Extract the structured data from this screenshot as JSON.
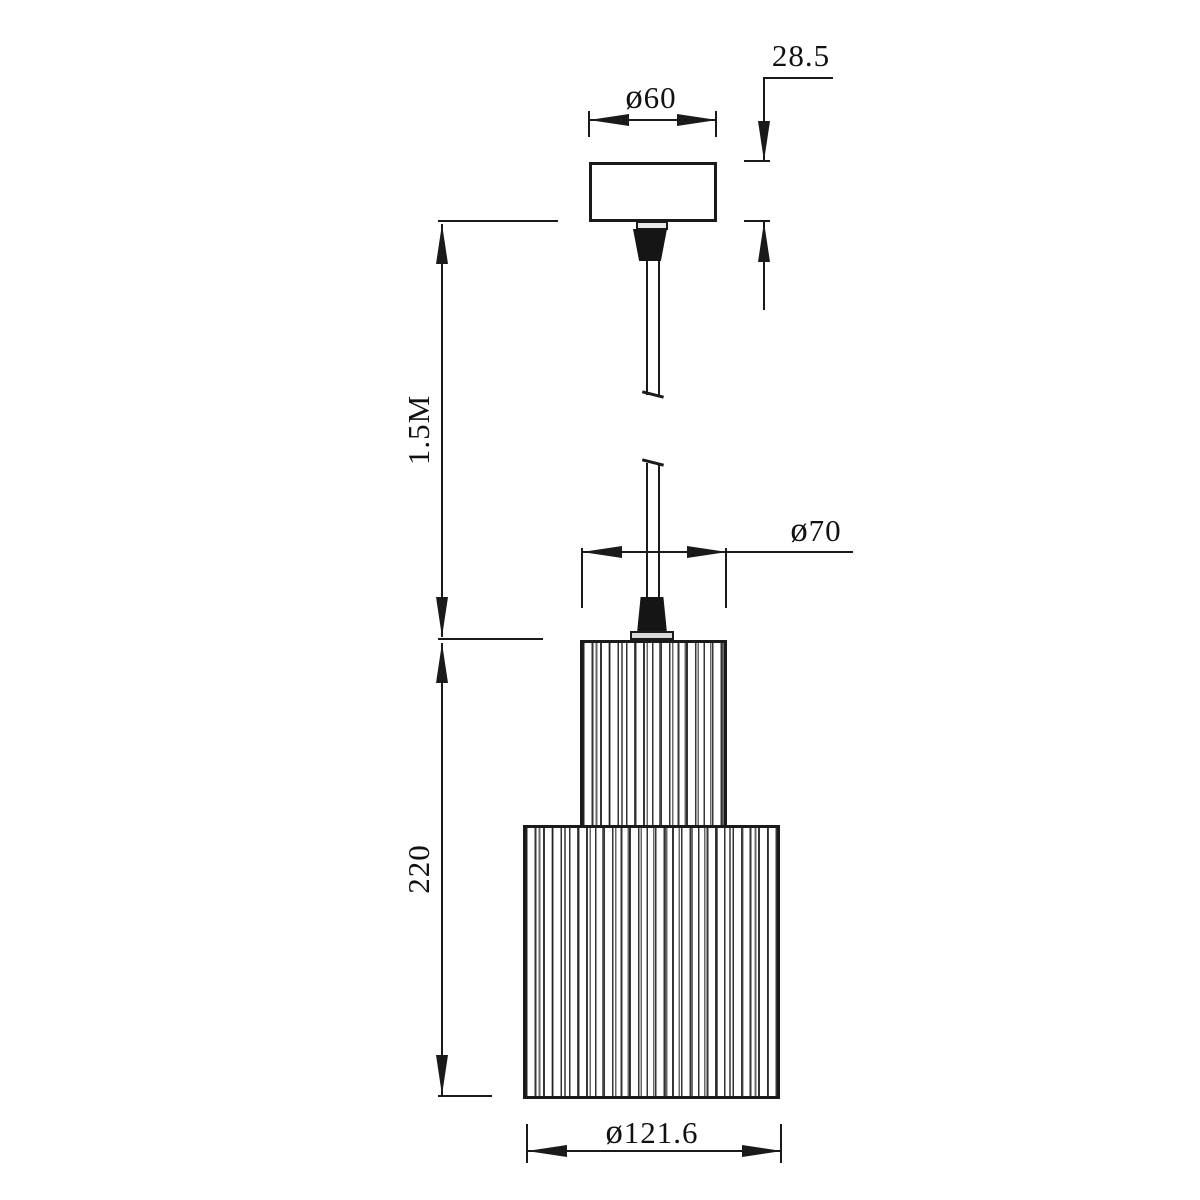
{
  "drawing": {
    "title": "pendant-lamp-dimension-drawing",
    "background_color": "#ffffff",
    "line_color": "#1a1a1a",
    "labels": {
      "canopy_height": "28.5",
      "canopy_diameter": "ø60",
      "cord_length": "1.5M",
      "shade_top_diameter": "ø70",
      "shade_height": "220",
      "shade_bottom_diameter": "ø121.6"
    },
    "values": {
      "canopy_height_mm": 28.5,
      "canopy_diameter_mm": 60,
      "cord_length_m": 1.5,
      "shade_top_diameter_mm": 70,
      "shade_height_mm": 220,
      "shade_bottom_diameter_mm": 121.6
    },
    "component_names": [
      "ceiling-canopy",
      "canopy-strain-relief",
      "suspension-cord",
      "cord-break-marks",
      "shade-strain-relief",
      "upper-ribbed-shade",
      "lower-ribbed-shade"
    ]
  }
}
